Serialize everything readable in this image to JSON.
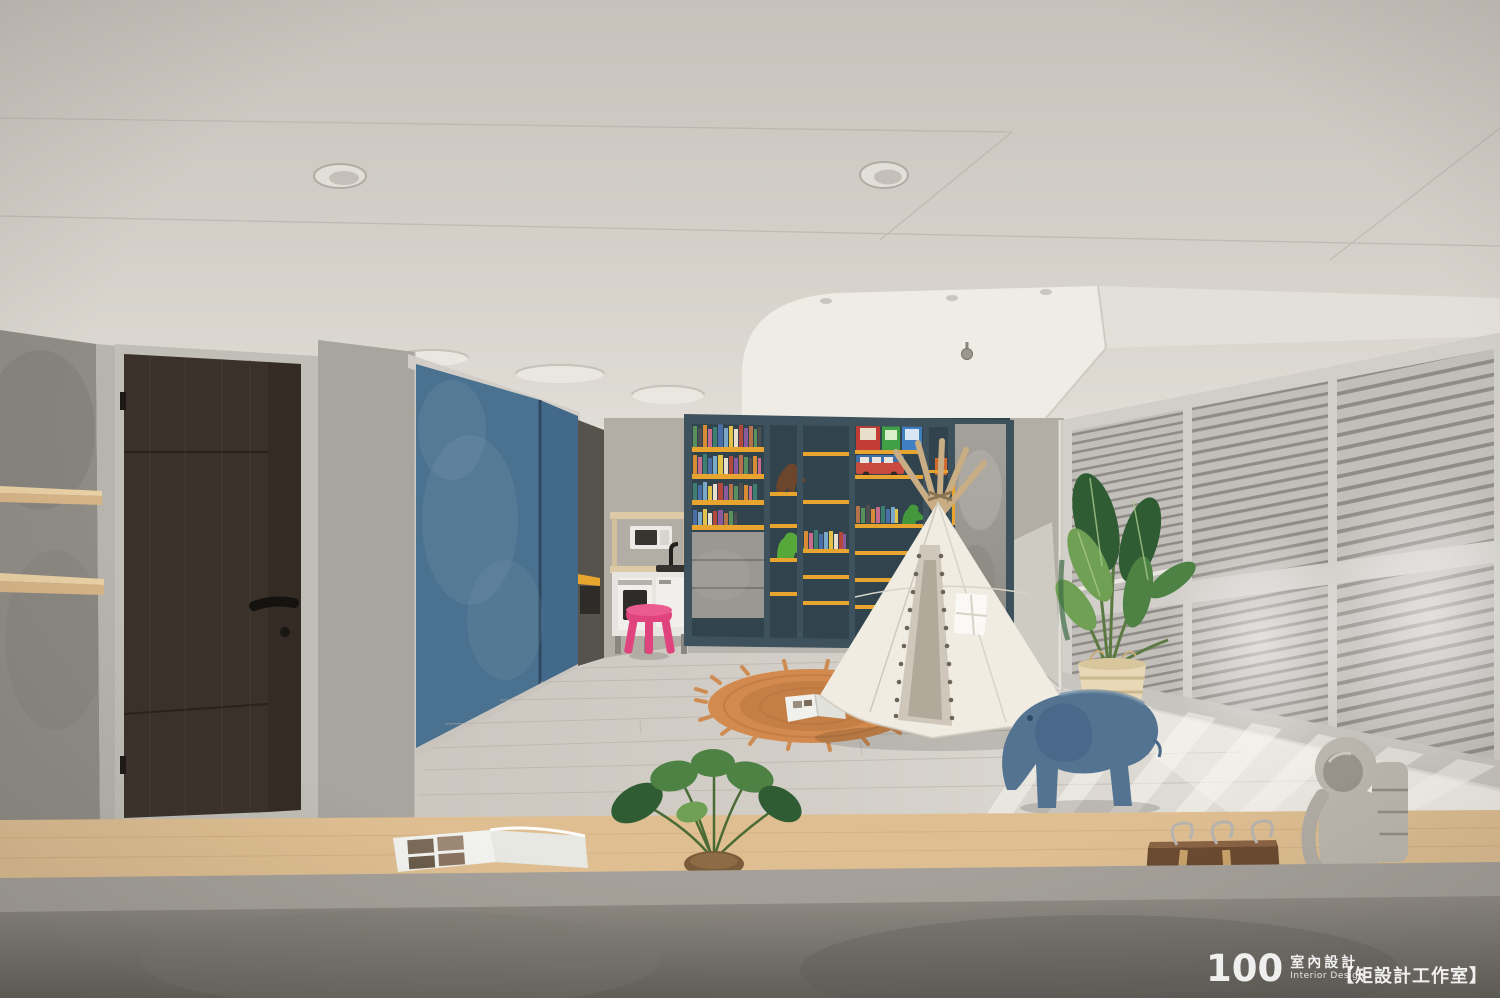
{
  "meta": {
    "description": "Interior photograph of a bright children's playroom: blue chalkboard wall, dark-blue bookshelf with yellow shelves and toys, white teepee tent on a round jute rug, play kitchen with pink stool, louvered shutters with sunlight, potted plants, blue Eames elephant toy, astronaut figurine on a wooden counter behind a concrete parapet.",
    "width": 1500,
    "height": 998
  },
  "watermark": {
    "number": "100",
    "cn": "室內設計",
    "en": "Interior Design",
    "studio": "【矩設計工作室】"
  },
  "palette": {
    "ceiling_top": "#c7c3bc",
    "ceiling_bottom": "#e5e2db",
    "cove_white": "#efece6",
    "wall_concrete": "#8f8b85",
    "wall_gray": "#a8a49e",
    "wall_back": "#b2aea5",
    "door_wood": "#3a312a",
    "door_frame": "#c1bdb7",
    "chalkboard": "#4a7290",
    "chalkboard_dark": "#42688a",
    "shelf_frame": "#3d525c",
    "shelf_backing": "#31444d",
    "shelf_yellow": "#e7a42f",
    "drawer_concrete": "#9b9792",
    "floor_left": "#c4c0b8",
    "floor_right": "#e6e3dd",
    "teepee": "#f0ece2",
    "rug": "#d28a4e",
    "blinds_slat": "#c2bfba",
    "blinds_gap": "#8f8c87",
    "blinds_frame": "#d2cfca",
    "plant_dark": "#2f5c33",
    "plant_mid": "#4e8245",
    "plant_light": "#6fa054",
    "basket": "#e8d8b6",
    "elephant": "#537391",
    "astronaut": "#bcb8b0",
    "counter_wood": "#dfbf92",
    "parapet_top": "#918d86",
    "parapet_bottom": "#66635d",
    "stool_pink": "#e0447e",
    "watermark": "#ffffff"
  },
  "book_colors": [
    "#b5483d",
    "#d98c35",
    "#e3c24a",
    "#5a8f5e",
    "#4a6fa8",
    "#8a5a9c",
    "#c86a8a",
    "#e8e0cc",
    "#4f4f4f",
    "#7aa8c9",
    "#b5714a",
    "#3f7f72"
  ],
  "scene": {
    "objects": [
      "ceiling-downlights",
      "cove-ceiling",
      "security-camera",
      "concrete-wall-shelves",
      "wood-door",
      "chalkboard-sliding-panels",
      "play-kitchen",
      "pink-stool",
      "bookshelf",
      "toy-dinosaurs",
      "toy-bus",
      "teepee-tent",
      "jute-rug",
      "open-picture-book",
      "louvered-shutters",
      "bird-of-paradise-plant",
      "woven-basket",
      "eames-elephant-toy",
      "calathea-plant",
      "open-magazine",
      "wooden-hook-organizer",
      "astronaut-figurine",
      "wood-counter",
      "concrete-parapet"
    ]
  }
}
